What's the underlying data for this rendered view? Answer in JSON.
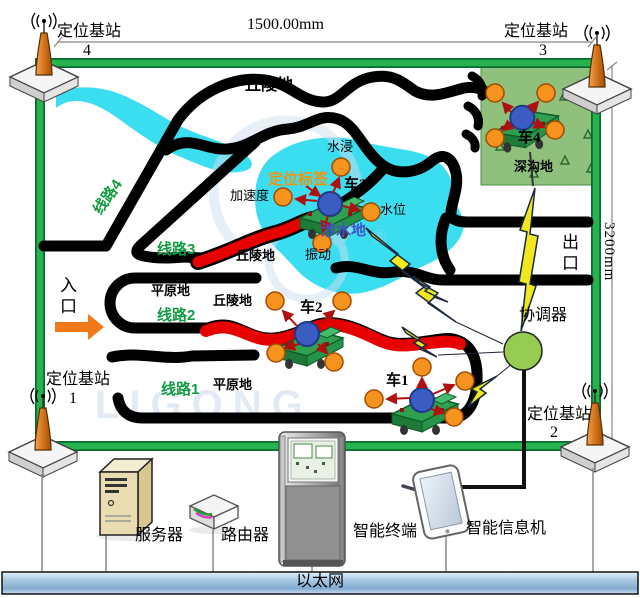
{
  "dimensions": {
    "top": "1500.00mm",
    "right": "3200mm"
  },
  "base_stations": {
    "tl": {
      "label": "定位基站",
      "number": "4"
    },
    "tr": {
      "label": "定位基站",
      "number": "3"
    },
    "bl": {
      "label": "定位基站",
      "number": "1"
    },
    "br": {
      "label": "定位基站",
      "number": "2"
    }
  },
  "routes": {
    "r1": "线路1",
    "r2": "线路2",
    "r3": "线路3",
    "r4": "线路4"
  },
  "terrain": {
    "hill_top": "丘陵地",
    "hill_mid": "丘陵地",
    "hill_low": "丘陵地",
    "plain_mid": "平原地",
    "plain_low": "平原地",
    "wading": "涉水地",
    "deep_ditch": "深沟地"
  },
  "gates": {
    "entrance": "入口",
    "exit": "出口"
  },
  "vehicles": {
    "v1": "车1",
    "v2": "车2",
    "v3": "车3",
    "v4": "车4"
  },
  "sensors": {
    "water_immersion": "水浸",
    "acceleration": "加速度",
    "water_level": "水位",
    "vibration": "振动",
    "tag": "定位标签"
  },
  "coordinator": "协调器",
  "devices": {
    "server": "服务器",
    "router": "路由器",
    "terminal": "智能终端",
    "info_machine": "智能信息机",
    "ethernet": "以太网"
  },
  "watermark": {
    "text": "LIGONG",
    "registered": "®"
  }
}
